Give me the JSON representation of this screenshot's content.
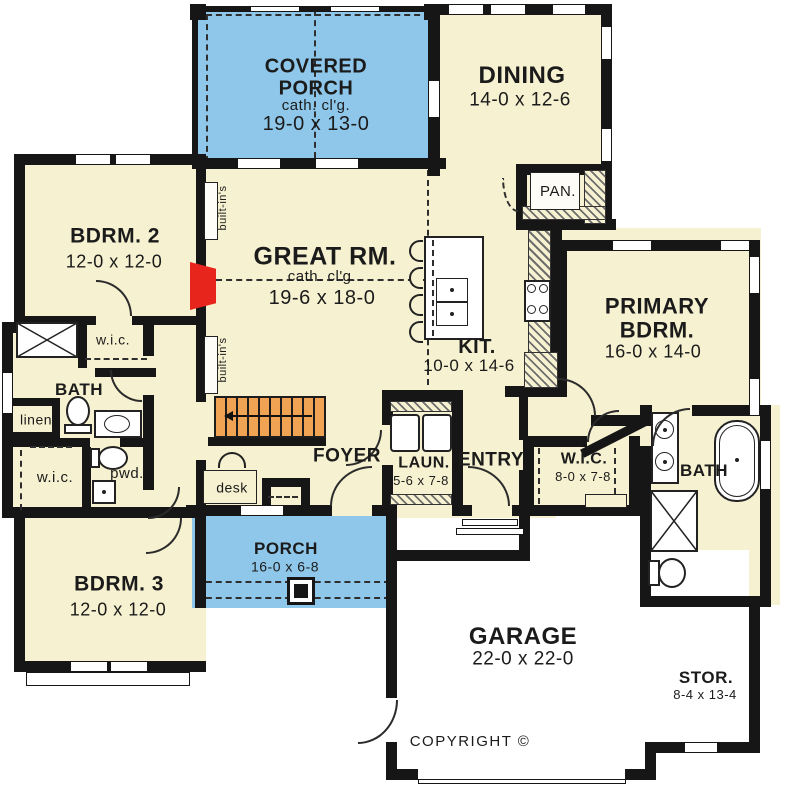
{
  "colors": {
    "porch_blue": "#8fc7ea",
    "room_cream": "#f6f1d0",
    "wall_black": "#161616",
    "stairs_orange": "#f0a352",
    "fireplace_red": "#e8251c"
  },
  "rooms": {
    "covered_porch": {
      "name": "COVERED PORCH",
      "note": "cath. cl'g.",
      "dims": "19-0 x 13-0"
    },
    "dining": {
      "name": "DINING",
      "dims": "14-0 x 12-6"
    },
    "pantry": {
      "name": "PAN."
    },
    "bedroom2": {
      "name": "BDRM. 2",
      "dims": "12-0 x 12-0"
    },
    "great_room": {
      "name": "GREAT RM.",
      "note": "cath. cl'g.",
      "dims": "19-6 x 18-0"
    },
    "kitchen": {
      "name": "KIT.",
      "dims": "10-0 x 14-6"
    },
    "primary_bedroom": {
      "name": "PRIMARY BDRM.",
      "dims": "16-0 x 14-0"
    },
    "bath": {
      "name": "BATH"
    },
    "wic": {
      "name": "w.i.c."
    },
    "linen": {
      "name": "linen"
    },
    "powder": {
      "name": "pwd."
    },
    "foyer": {
      "name": "FOYER"
    },
    "desk": {
      "name": "desk"
    },
    "laundry": {
      "name": "LAUN.",
      "dims": "5-6 x 7-8"
    },
    "entry": {
      "name": "ENTRY"
    },
    "primary_wic": {
      "name": "W.I.C.",
      "dims": "8-0 x 7-8"
    },
    "primary_bath": {
      "name": "BATH"
    },
    "bedroom3": {
      "name": "BDRM. 3",
      "dims": "12-0 x 12-0"
    },
    "porch": {
      "name": "PORCH",
      "dims": "16-0 x 6-8"
    },
    "garage": {
      "name": "GARAGE",
      "dims": "22-0 x 22-0"
    },
    "storage": {
      "name": "STOR.",
      "dims": "8-4 x 13-4"
    }
  },
  "annotations": {
    "builtins": "built-in's",
    "copyright": "COPYRIGHT ©"
  }
}
